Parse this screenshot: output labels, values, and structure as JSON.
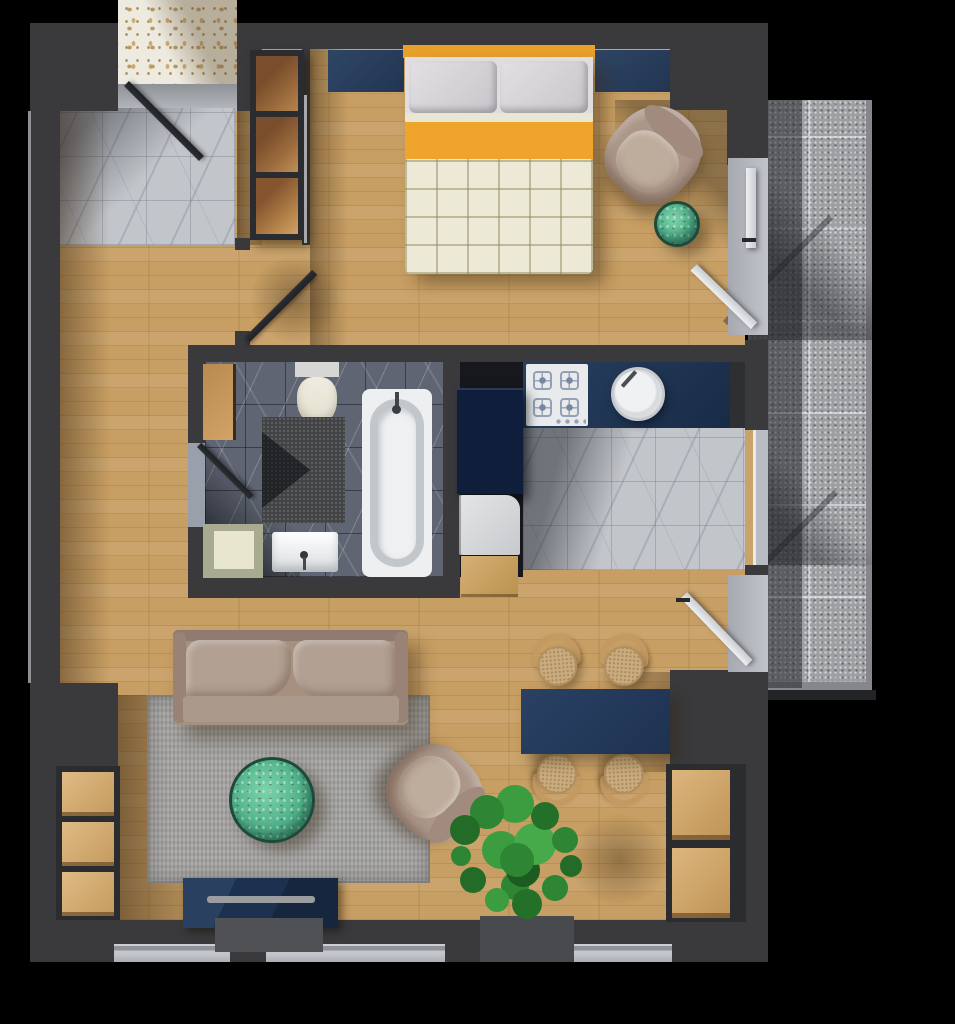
{
  "scene": {
    "title": "3D rendered apartment floor plan, top-down view",
    "background_color": "#000000",
    "palette": {
      "wall": "#3a3a3d",
      "wood_floor": "#c79e63",
      "light_marble": "#c2c5ca",
      "dark_marble": "#5f6572",
      "balcony_granite": "#9da0a3",
      "terrazzo": "#edeadf",
      "navy_furniture": "#24385a",
      "bed_accent_orange": "#efa42c",
      "table_accent_green": "#4fb28a",
      "upholstery_taupe": "#ac968a",
      "rug_gray": "#a3a2a0",
      "plant_green": "#2e8533"
    },
    "rooms": [
      {
        "name": "entry-hall",
        "floor": "light-marble-tiles"
      },
      {
        "name": "bedroom",
        "floor": "wood-planks"
      },
      {
        "name": "bathroom",
        "floor": "dark-marble-tiles"
      },
      {
        "name": "kitchen",
        "floor": "light-marble-tiles"
      },
      {
        "name": "living-dining-room",
        "floor": "wood-planks"
      },
      {
        "name": "balcony",
        "floor": "granite-tiles"
      }
    ],
    "furniture_and_fixtures": [
      "entrance-door",
      "terrazzo-landing",
      "wardrobe",
      "double-bed-with-orange-frame",
      "navy-headboard-panels",
      "pillows",
      "quilted-duvet",
      "bedroom-armchair",
      "green-marble-side-table",
      "bedroom-balcony-door",
      "toilet",
      "bathtub",
      "washbasin",
      "dark-shower-mat",
      "bathroom-wood-cabinet",
      "laundry-tray",
      "bathroom-door",
      "kitchen-counter-navy",
      "gas-hob-4-burners",
      "round-kitchen-sink",
      "fridge-tall-unit",
      "dishwasher",
      "wood-stool",
      "kitchen-window",
      "living-balcony-door",
      "gray-rug",
      "taupe-sofa",
      "green-marble-coffee-table",
      "lounge-armchair",
      "navy-tv-stand",
      "soundbar",
      "navy-dining-table",
      "dining-chair-1",
      "dining-chair-2",
      "dining-chair-3",
      "dining-chair-4",
      "potted-plant",
      "left-sideboard-3-cubbies",
      "right-cabinet-2-cubbies",
      "window-sill-1",
      "window-sill-2",
      "window-sill-3"
    ],
    "counts": {
      "dining_chairs": 4,
      "hob_burners": 4,
      "balcony_doors": 2,
      "bottom_windows": 3
    }
  }
}
